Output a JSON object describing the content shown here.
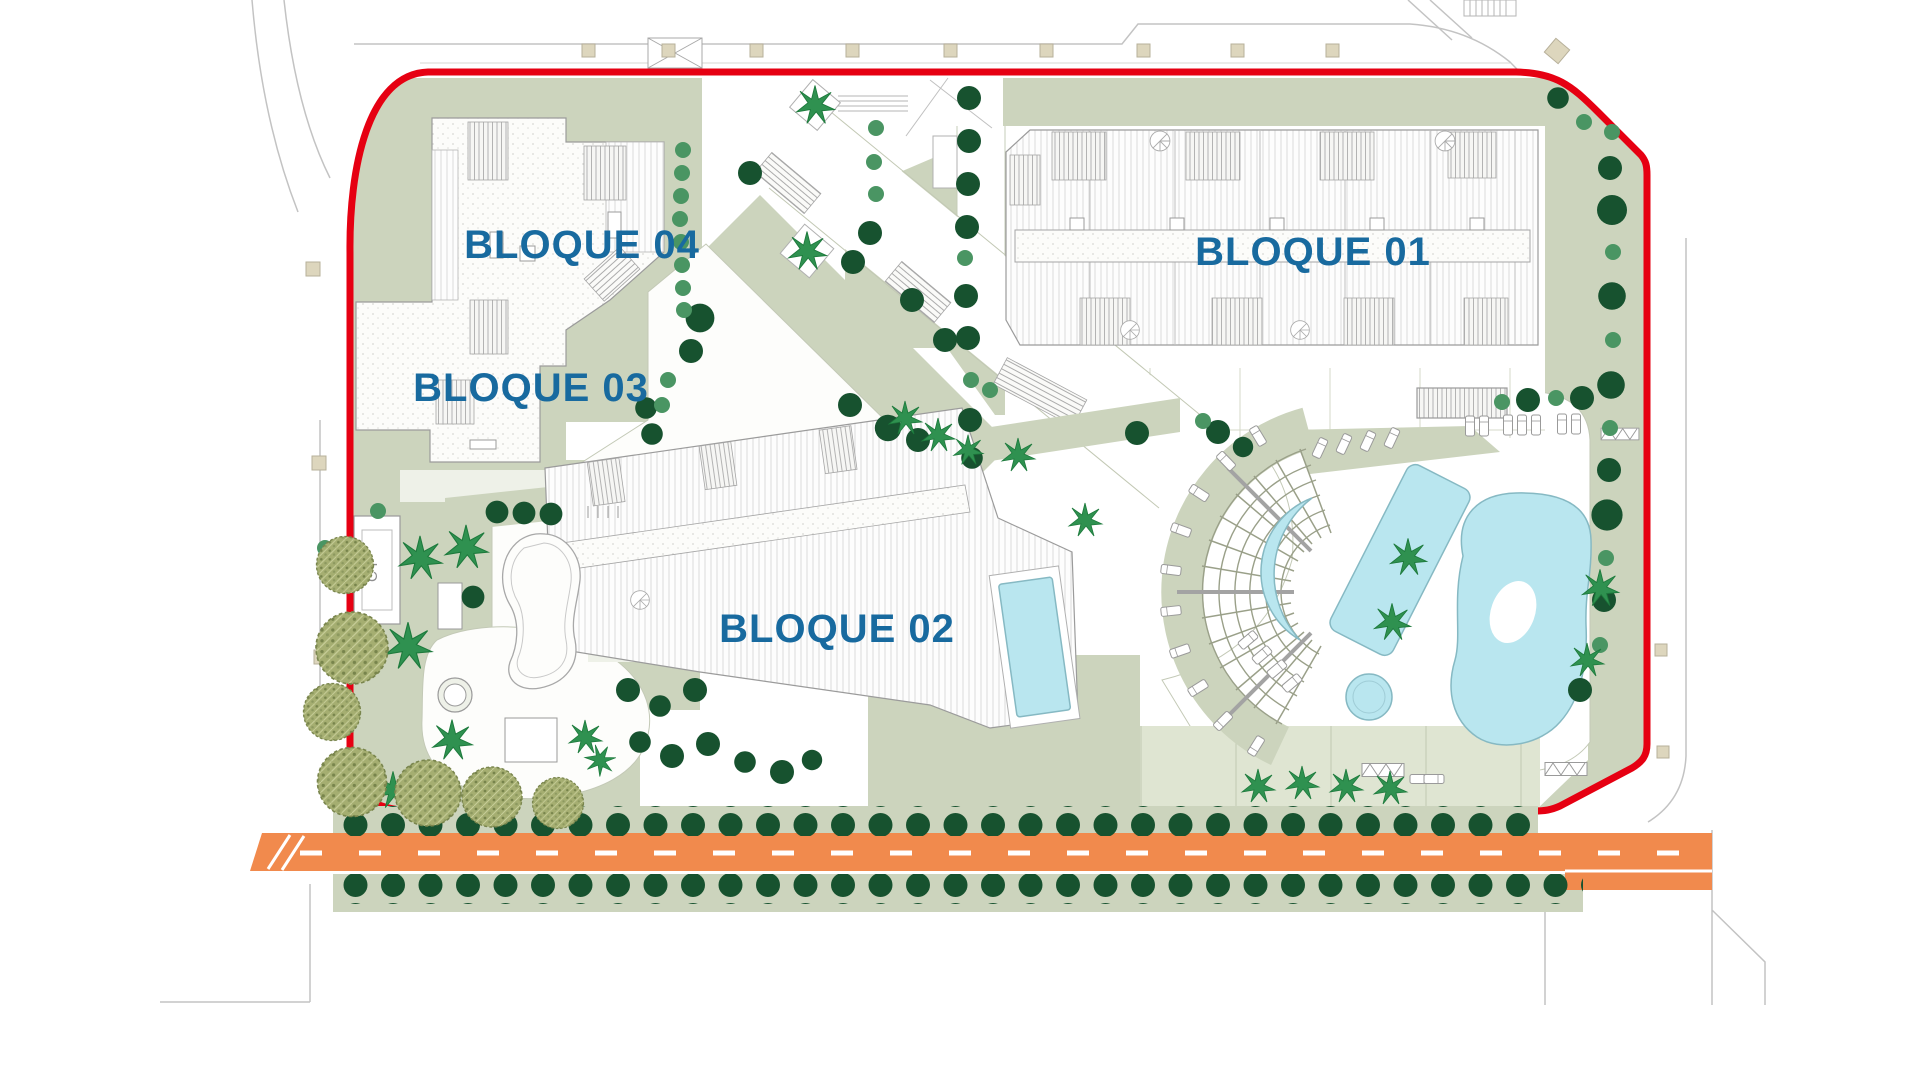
{
  "plan": {
    "title": "Residential development site plan",
    "blocks": [
      {
        "id": "bloque-01",
        "label": "BLOQUE 01"
      },
      {
        "id": "bloque-02",
        "label": "BLOQUE 02"
      },
      {
        "id": "bloque-03",
        "label": "BLOQUE 03"
      },
      {
        "id": "bloque-04",
        "label": "BLOQUE 04"
      }
    ],
    "utility": {
      "label": "CT"
    },
    "colors": {
      "boundary_red": "#e60012",
      "block_label_blue": "#186a9f",
      "landscape_sage": "#ccd4bd",
      "landscape_light": "#dde3d1",
      "pool_cyan": "#b9e6ef",
      "road_orange": "#f18a4d",
      "tree_dark_green": "#17522f",
      "tree_medium_green": "#4a9563",
      "tree_olive": "#a5ae71",
      "beige_paving": "#ddd6bd"
    }
  }
}
